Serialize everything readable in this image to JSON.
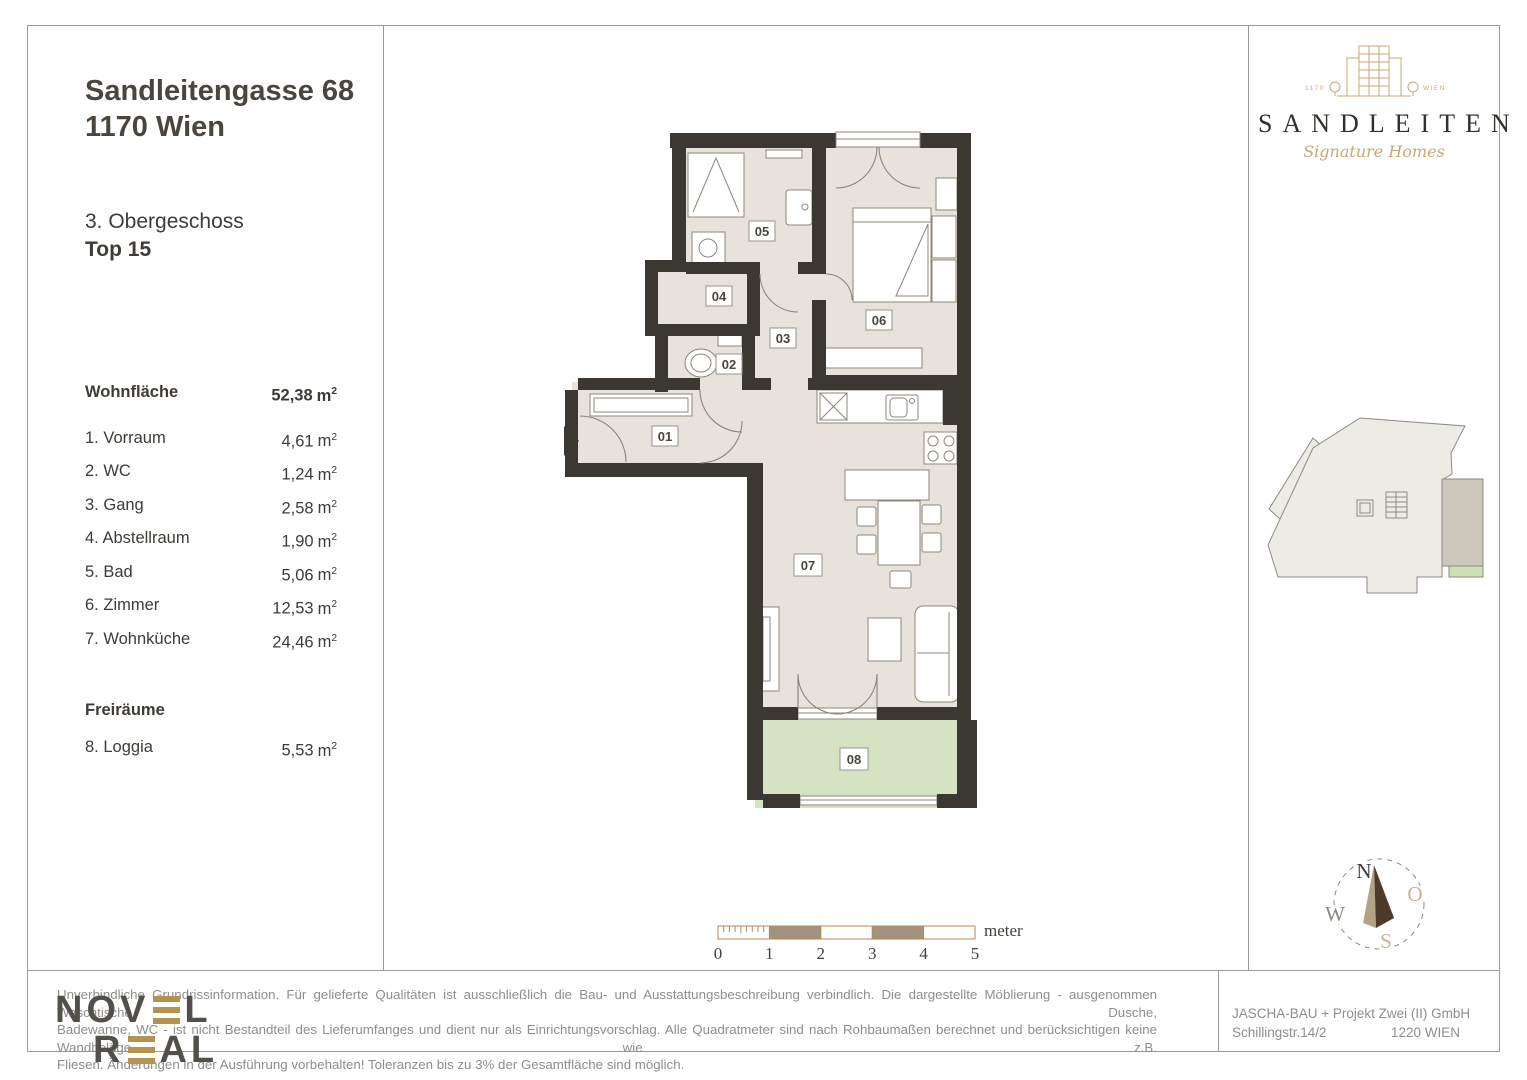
{
  "header": {
    "line1": "Sandleitengasse 68",
    "line2": "1170 Wien",
    "floor": "3. Obergeschoss",
    "unit": "Top 15"
  },
  "areas": {
    "total_label": "Wohnfläche",
    "total_value": "52,38",
    "unit": "m",
    "unit_sup": "2",
    "rows": [
      {
        "num": "1.",
        "name": "Vorraum",
        "value": "4,61"
      },
      {
        "num": "2.",
        "name": "WC",
        "value": "1,24"
      },
      {
        "num": "3.",
        "name": "Gang",
        "value": "2,58"
      },
      {
        "num": "4.",
        "name": "Abstellraum",
        "value": "1,90"
      },
      {
        "num": "5.",
        "name": "Bad",
        "value": "5,06"
      },
      {
        "num": "6.",
        "name": "Zimmer",
        "value": "12,53"
      },
      {
        "num": "7.",
        "name": "Wohnküche",
        "value": "24,46"
      }
    ],
    "free_title": "Freiräume",
    "free": {
      "num": "8.",
      "name": "Loggia",
      "value": "5,53"
    }
  },
  "plan": {
    "labels": {
      "r01": "01",
      "r02": "02",
      "r03": "03",
      "r04": "04",
      "r05": "05",
      "r06": "06",
      "r07": "07",
      "r08": "08"
    },
    "scale": {
      "t0": "0",
      "t1": "1",
      "t2": "2",
      "t3": "3",
      "t4": "4",
      "t5": "5",
      "unit": "meter"
    }
  },
  "brand": {
    "name": "SANDLEITEN",
    "tagline": "Signature Homes",
    "small_left": "1170",
    "small_right": "WIEN"
  },
  "compass": {
    "n": "N",
    "e": "O",
    "s": "S",
    "w": "W"
  },
  "footer": {
    "disclaimer_l1": "Unverbindliche Grundrissinformation. Für gelieferte Qualitäten ist ausschließlich die Bau- und Ausstattungsbeschreibung verbindlich. Die dargestellte Möblierung - ausgenommen Waschtische, Dusche,",
    "disclaimer_l2": "Badewanne, WC - ist nicht Bestandteil des Lieferumfanges und dient nur als Einrichtungsvorschlag. Alle Quadratmeter sind nach Rohbaumaßen berechnet und berücksichtigen keine Wandbeläge wie z.B.",
    "disclaimer_l3": "Fliesen. Änderungen in der Ausführung vorbehalten! Toleranzen bis zu 3% der Gesamtfläche sind möglich.",
    "company": "JASCHA-BAU + Projekt Zwei (II) GmbH",
    "street": "Schillingstr.14/2",
    "city": "1220 WIEN",
    "logo": {
      "p1": "NOV",
      "p2": "L",
      "p3": "R",
      "p4": "AL"
    }
  },
  "colors": {
    "wall": "#3b3733",
    "floor": "#e7e2db",
    "loggia": "#d6e3c3",
    "gold": "#c9a874"
  }
}
